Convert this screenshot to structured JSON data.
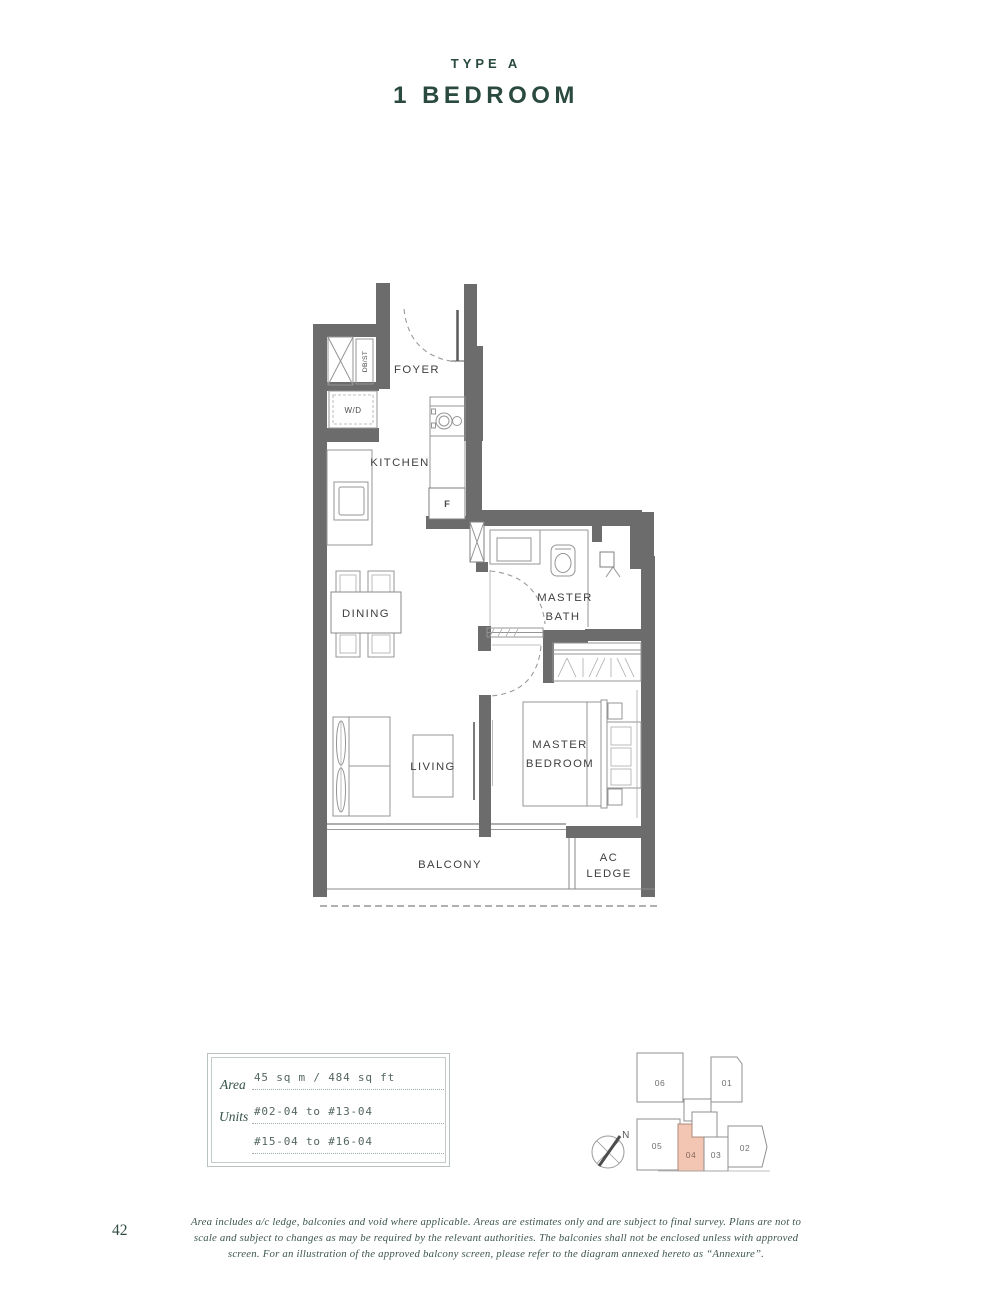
{
  "page": {
    "type_label": "TYPE A",
    "title": "1 BEDROOM",
    "page_number": "42",
    "footer_lines": [
      "Area includes a/c ledge, balconies and void where applicable. Areas are estimates only and are subject to final survey. Plans are not to",
      "scale and subject to changes as may be required by the relevant authorities. The balconies shall not be enclosed unless with approved",
      "screen. For an illustration of the approved balcony screen, please refer to the diagram annexed hereto as “Annexure”."
    ]
  },
  "plan": {
    "labels": {
      "foyer": "FOYER",
      "kitchen": "KITCHEN",
      "dining": "DINING",
      "living": "LIVING",
      "balcony": "BALCONY",
      "fridge": "F",
      "washer_dryer": "W/D",
      "db_store": "DB/ST",
      "master_bath": [
        "MASTER",
        "BATH"
      ],
      "master_bedroom": [
        "MASTER",
        "BEDROOM"
      ],
      "ac_ledge": [
        "AC",
        "LEDGE"
      ]
    }
  },
  "info_box": {
    "area_label": "Area",
    "area_value": "45 sq m / 484 sq ft",
    "units_label": "Units",
    "units_value_line1": "#02-04 to #13-04",
    "units_value_line2": "#15-04 to #16-04"
  },
  "key_plan": {
    "north_label": "N",
    "highlighted_unit": "04",
    "highlight_color": "#f2c6b2",
    "units": [
      "06",
      "01",
      "05",
      "04",
      "03",
      "02"
    ]
  },
  "colors": {
    "accent_green": "#2a4a3f",
    "wall_gray": "#6c6c6c",
    "highlight_salmon": "#f2c6b2"
  }
}
